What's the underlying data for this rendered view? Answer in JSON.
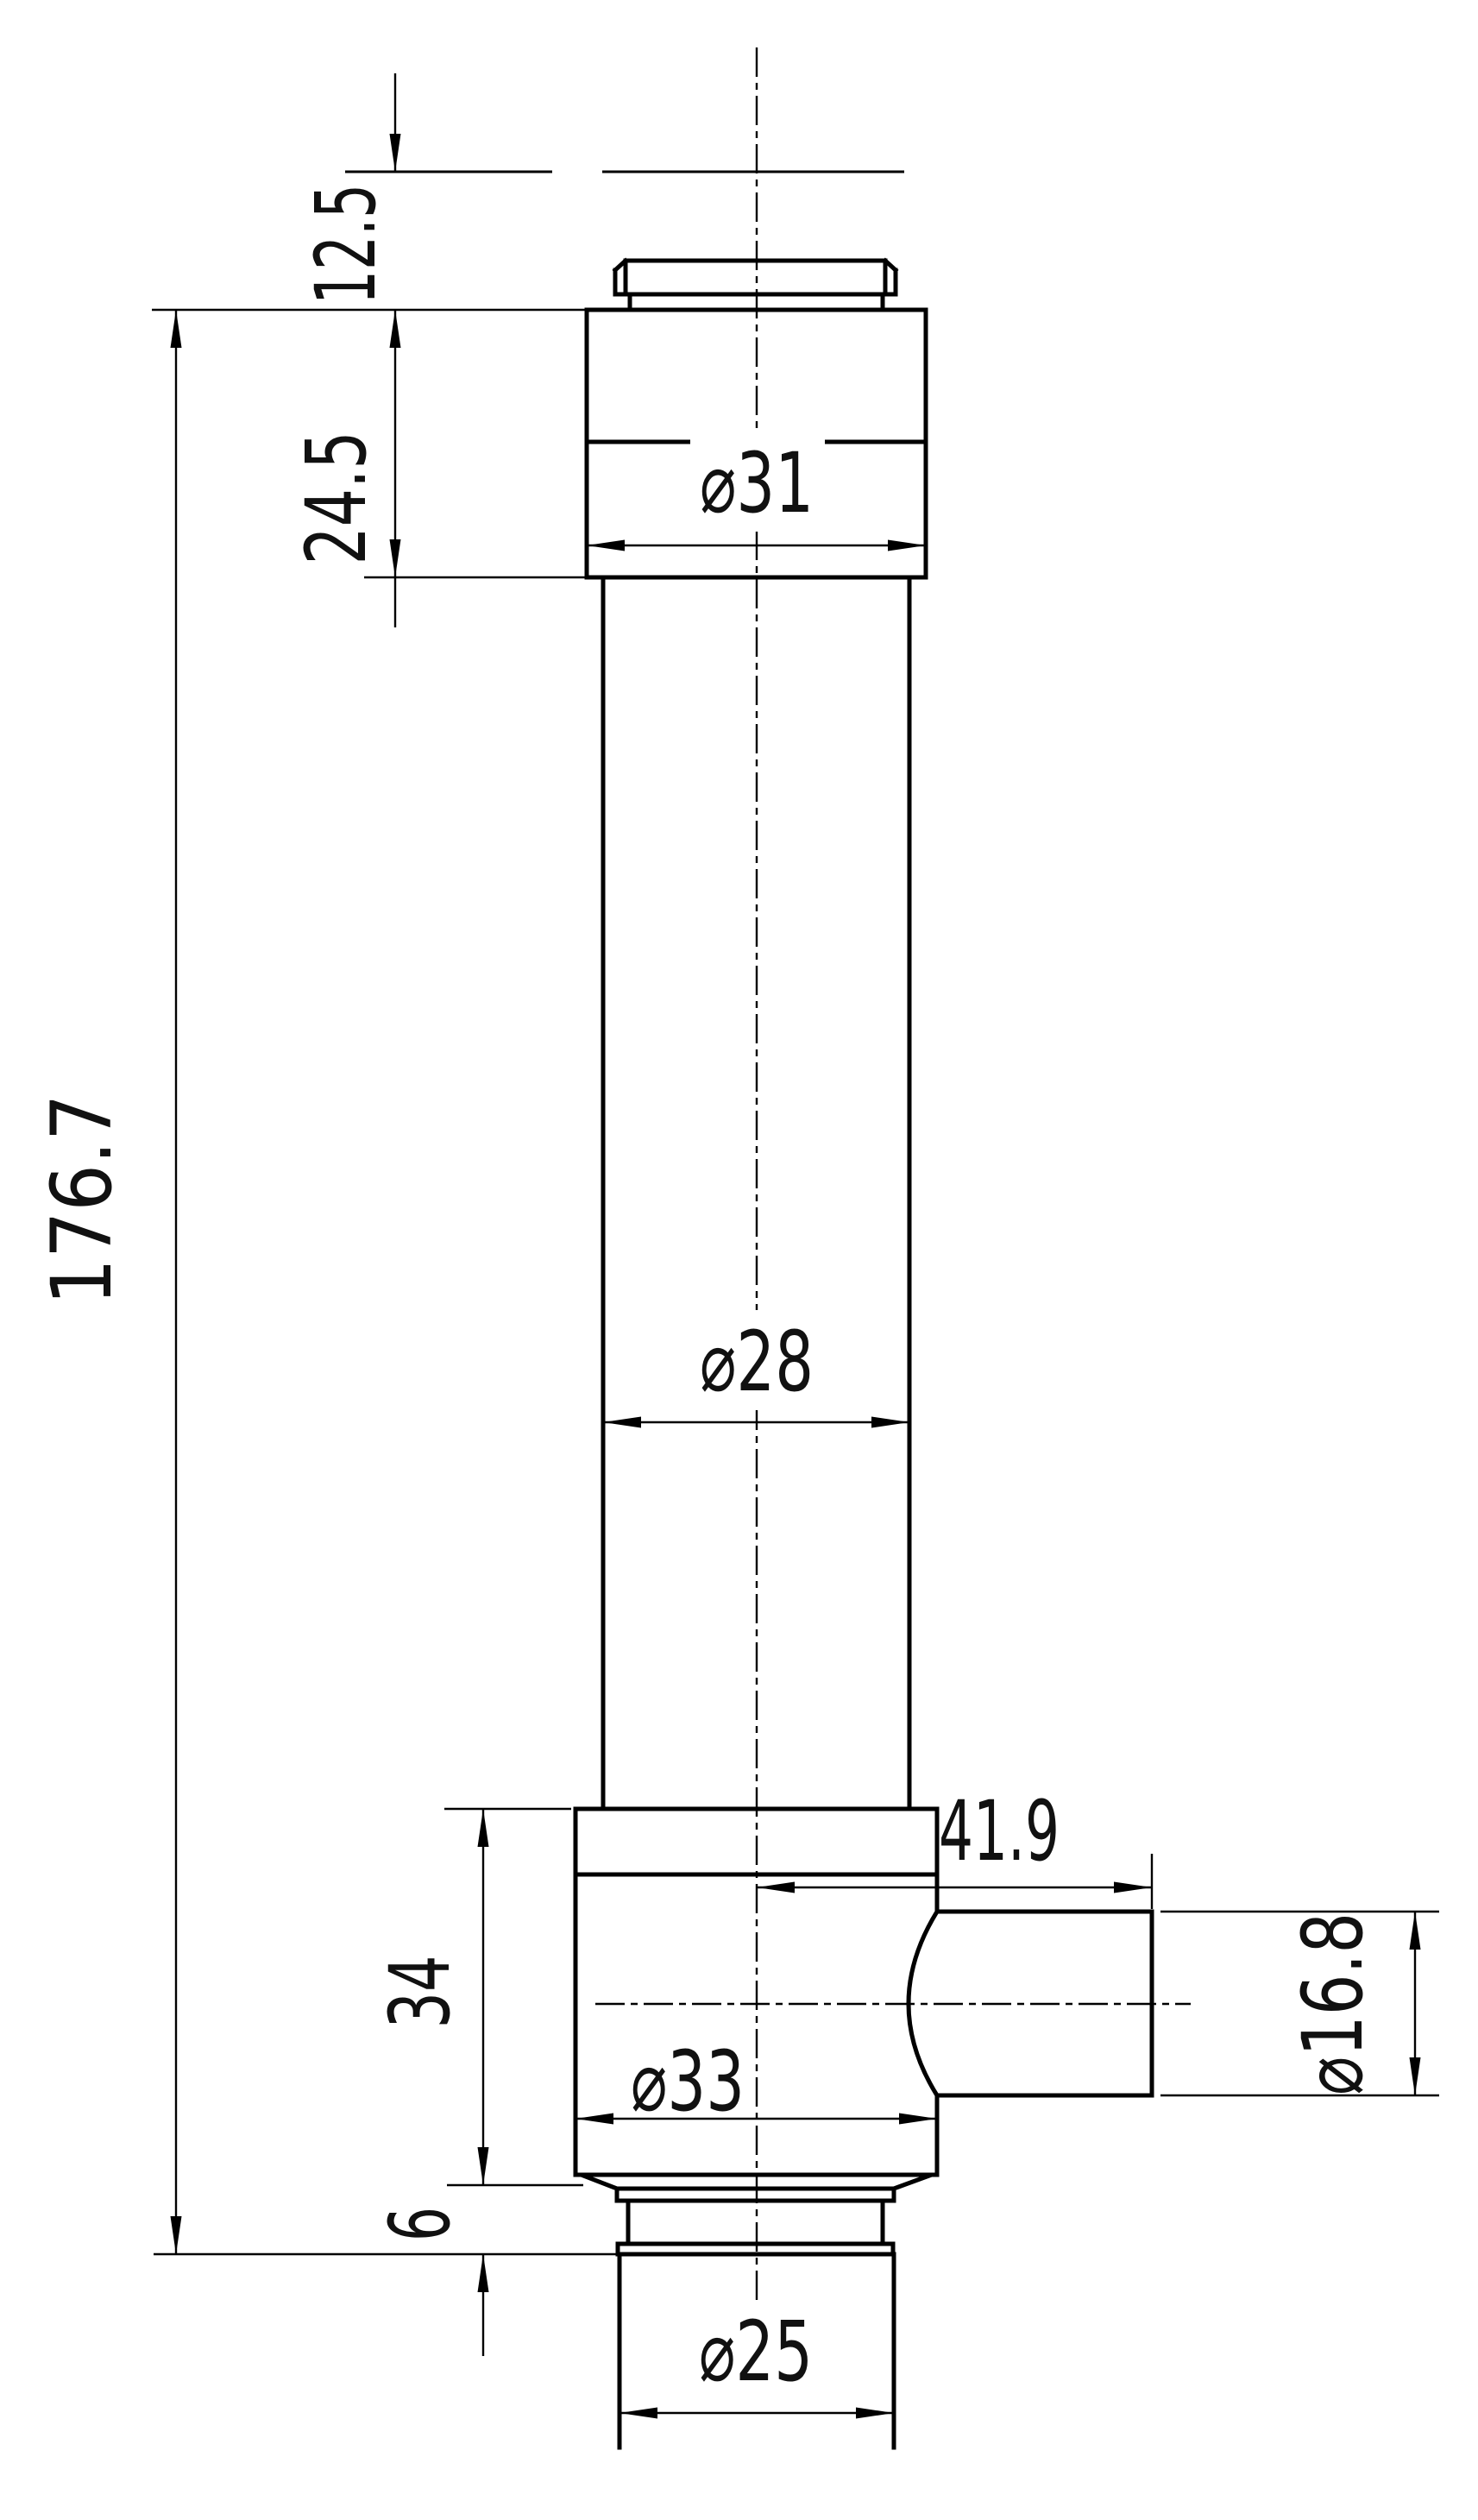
{
  "drawing": {
    "background_color": "#ffffff",
    "line_color": "#000000",
    "dimensions": {
      "top_offset": "12.5",
      "upper_block_height": "24.5",
      "overall_length": "176.7",
      "upper_block_diameter": "⌀31",
      "body_diameter": "⌀28",
      "lower_block_height": "34",
      "lower_block_diameter": "⌀33",
      "collar_height": "6",
      "stem_diameter": "⌀25",
      "port_length": "41.9",
      "port_diameter": "⌀16.8"
    }
  }
}
